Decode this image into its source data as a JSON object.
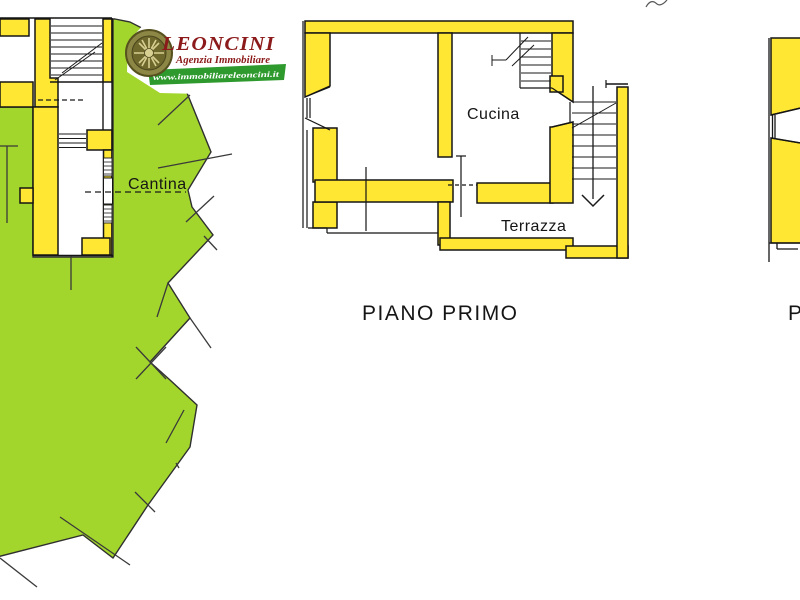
{
  "branding": {
    "logo_title": "LEONCINI",
    "logo_subtitle": "Agenzia Immobiliare",
    "logo_website": "www.immobiliareleoncini.it"
  },
  "floor_plans": {
    "ground_floor": {
      "room_labels": {
        "cantina": "Cantina"
      }
    },
    "first_floor": {
      "title": "PIANO PRIMO",
      "room_labels": {
        "cucina": "Cucina",
        "terrazza": "Terrazza"
      }
    },
    "right_partial": {
      "title_partial": "P"
    }
  },
  "colors": {
    "parcel_green": "#A3D62C",
    "wall_yellow": "#FFE733",
    "outline_black": "#151515",
    "logo_red": "#8C1A1A",
    "logo_band_green": "#2E9A2E"
  }
}
